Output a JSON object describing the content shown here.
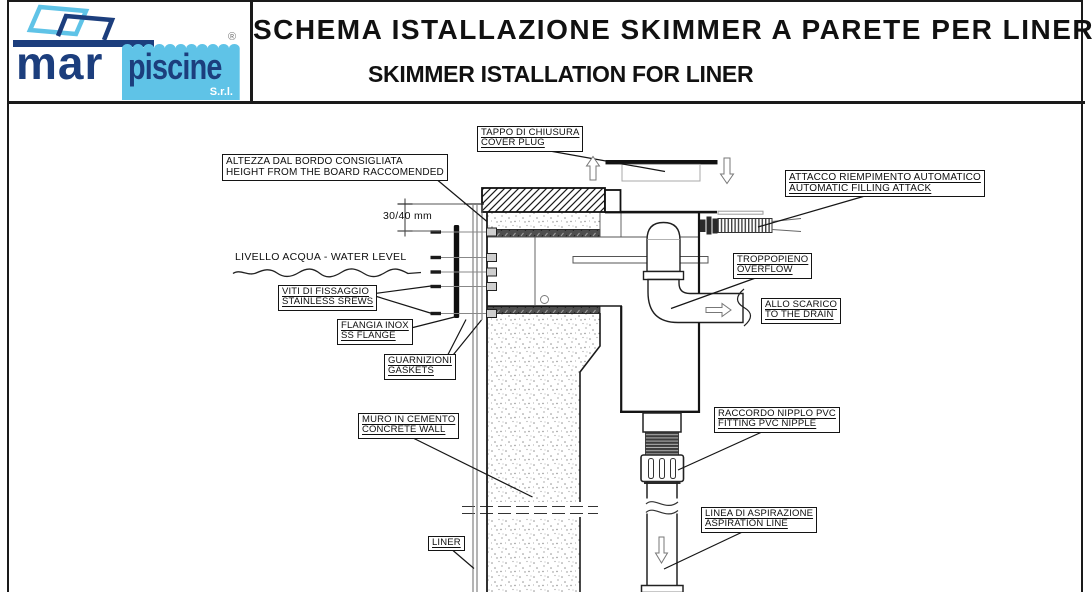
{
  "header": {
    "title_line1": "SCHEMA ISTALLAZIONE SKIMMER A PARETE PER LINER",
    "title_line2": "SKIMMER ISTALLATION FOR LINER",
    "logo": {
      "word_mar": "mar",
      "word_piscine": "piscine",
      "suffix": "S.r.l.",
      "registered_mark": "®",
      "color_navy": "#1c3e7d",
      "color_light_blue": "#5fc3e7"
    }
  },
  "diagram": {
    "callouts": {
      "cover_plug": {
        "it": "TAPPO DI CHIUSURA",
        "en": "COVER PLUG"
      },
      "height_from_board": {
        "it": "ALTEZZA DAL BORDO CONSIGLIATA",
        "en": "HEIGHT FROM THE BOARD RACCOMENDED"
      },
      "automatic_filling": {
        "it": "ATTACCO RIEMPIMENTO AUTOMATICO",
        "en": "AUTOMATIC FILLING ATTACK"
      },
      "fixing_screws": {
        "it": "VITI DI FISSAGGIO",
        "en": "STAINLESS SREWS"
      },
      "ss_flange": {
        "it": "FLANGIA INOX",
        "en": "SS FLANGE"
      },
      "gaskets": {
        "it": "GUARNIZIONI",
        "en": "GASKETS"
      },
      "overflow": {
        "it": "TROPPOPIENO",
        "en": "OVERFLOW"
      },
      "to_drain": {
        "it": "ALLO SCARICO",
        "en": "TO THE DRAIN"
      },
      "concrete_wall": {
        "it": "MURO IN CEMENTO",
        "en": "CONCRETE WALL"
      },
      "pvc_nipple": {
        "it": "RACCORDO NIPPLO PVC",
        "en": "FITTING PVC NIPPLE"
      },
      "aspiration_line": {
        "it": "LINEA DI ASPIRAZIONE",
        "en": "ASPIRATION LINE"
      },
      "liner": {
        "it": "LINER"
      }
    },
    "annotations": {
      "water_level": "LIVELLO ACQUA - WATER LEVEL",
      "dimension": "30/40 mm"
    }
  }
}
